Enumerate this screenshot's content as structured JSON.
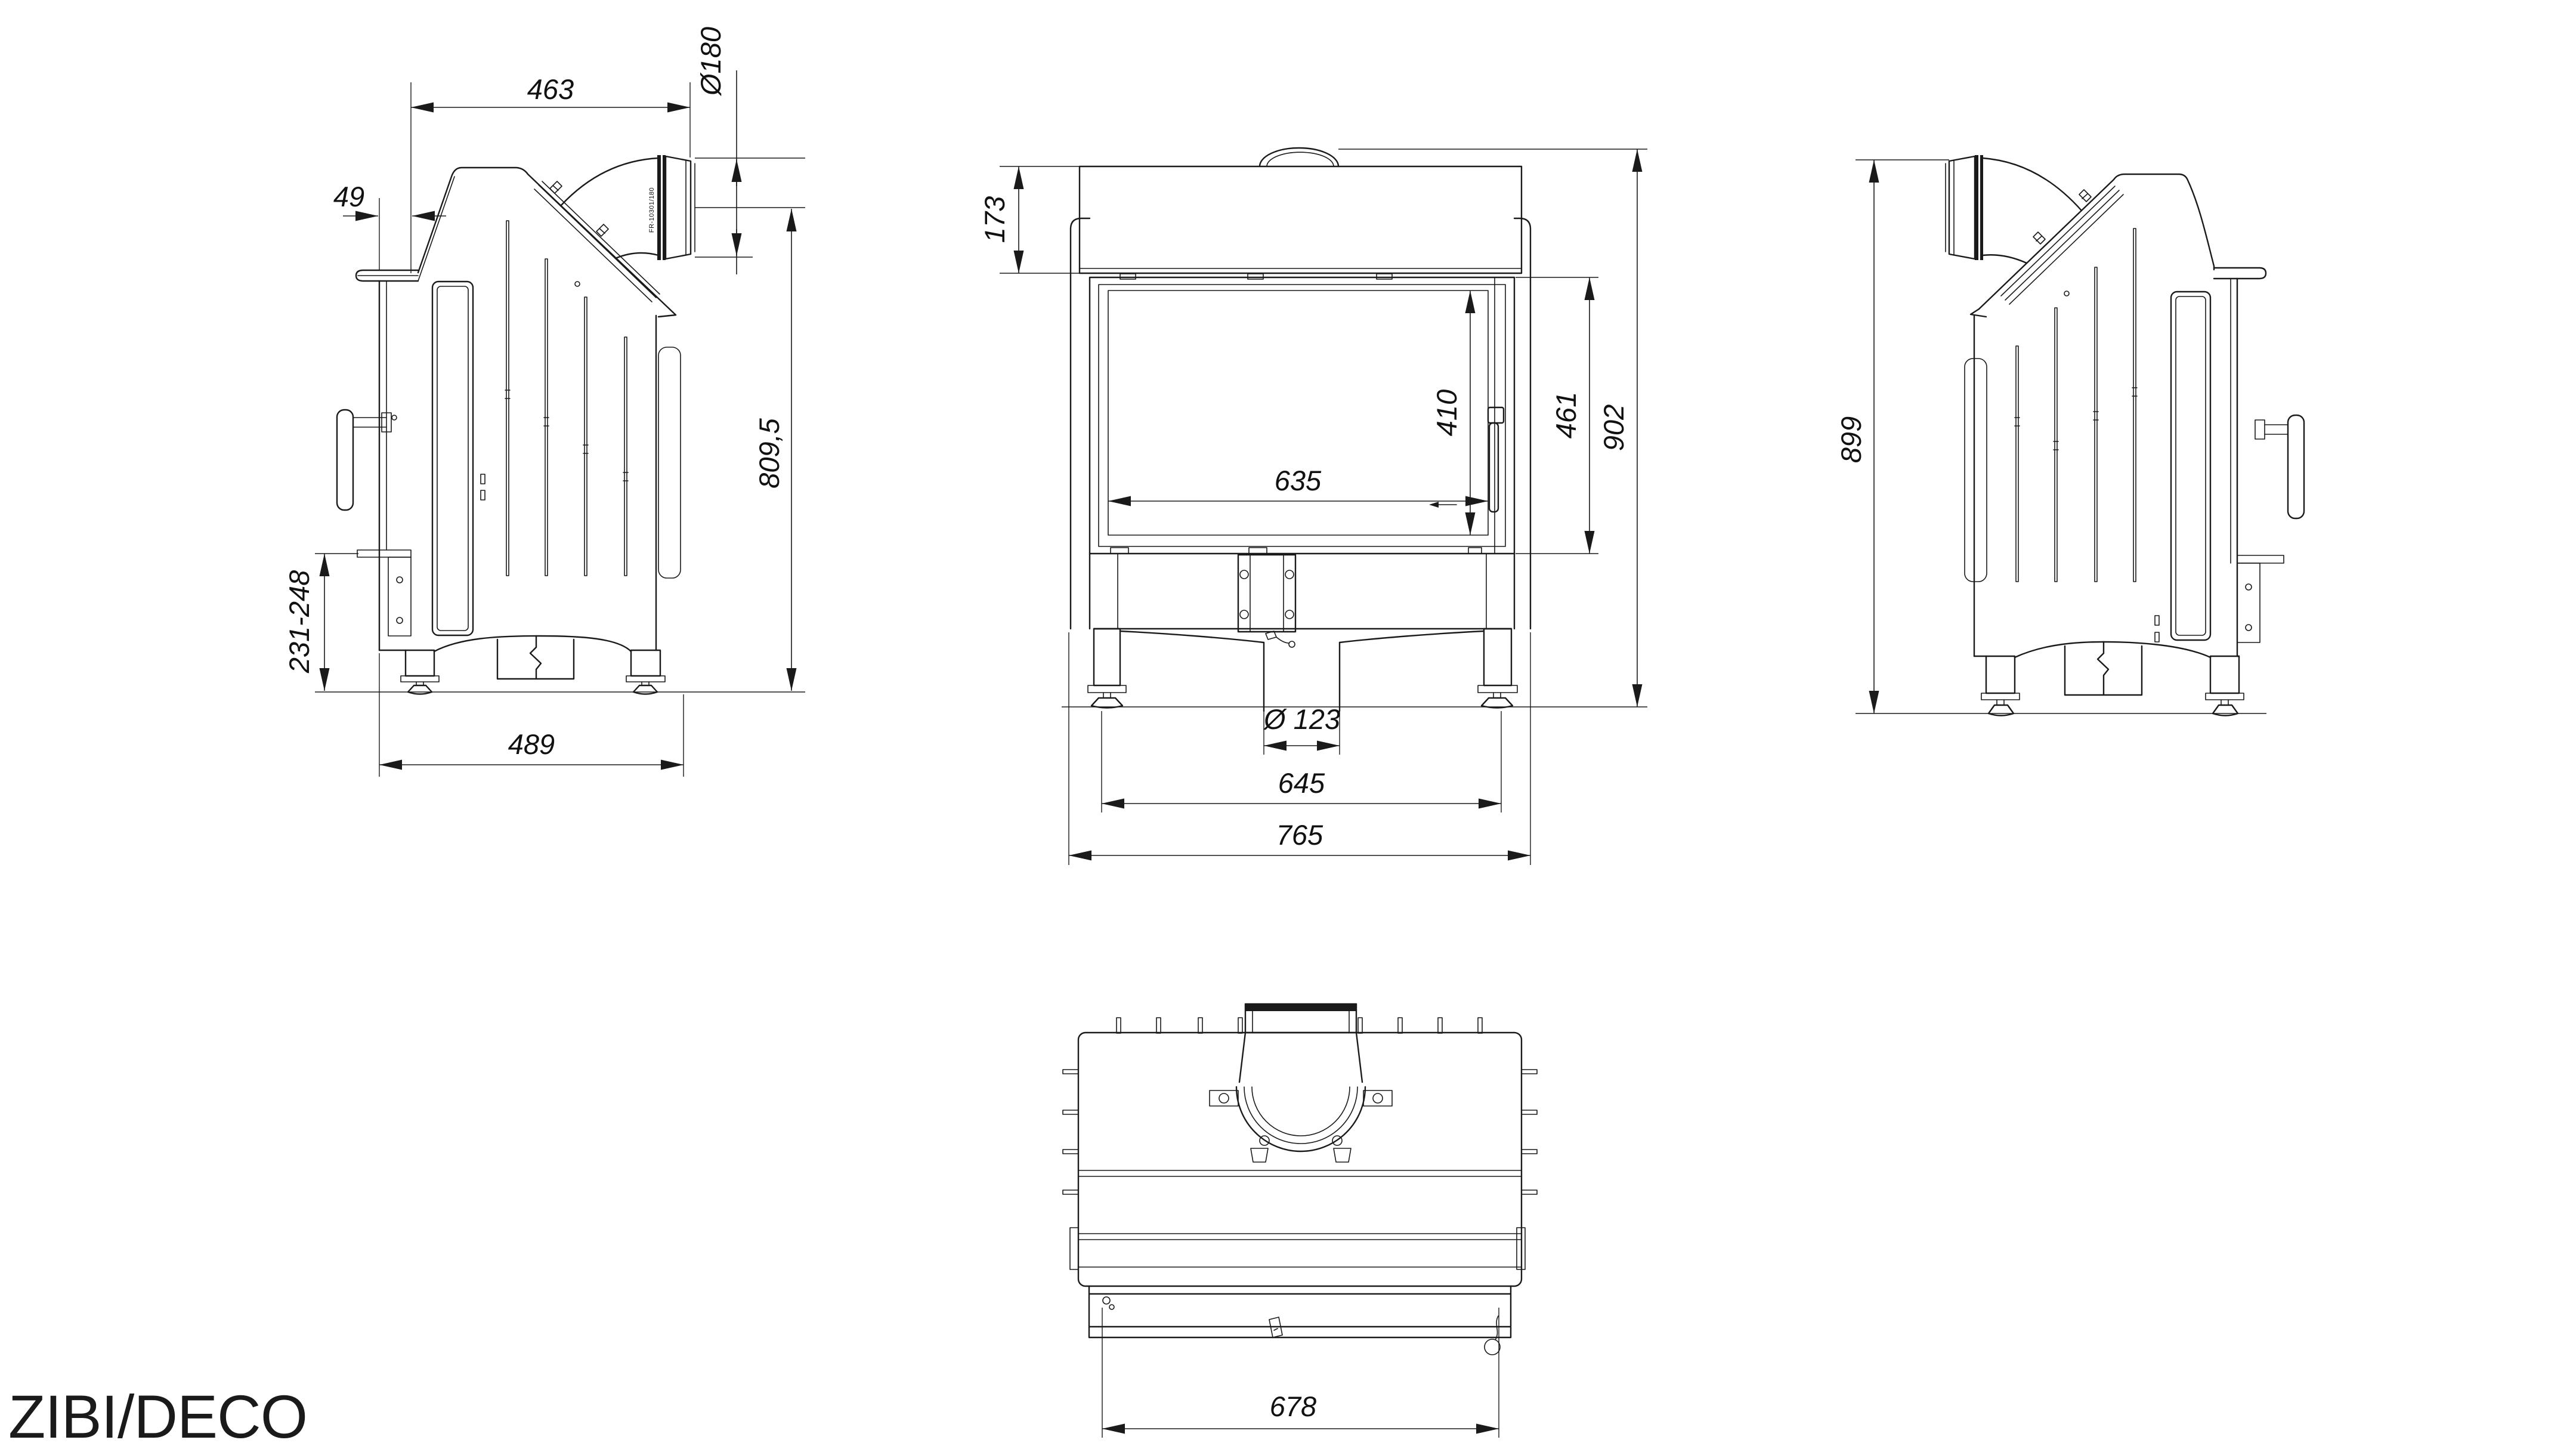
{
  "title": "ZIBI/DECO",
  "views": {
    "side_left": {
      "dims": {
        "top_width": "463",
        "flue_diameter": "Ø180",
        "front_offset": "49",
        "height_to_flue_axis": "809,5",
        "base_height": "231-248",
        "depth": "489"
      },
      "flue_marking": "FR-10301/180"
    },
    "front": {
      "dims": {
        "hood_height": "173",
        "glass_height": "410",
        "door_height": "461",
        "total_height": "902",
        "glass_width": "635",
        "air_inlet_diameter": "Ø 123",
        "feet_spacing": "645",
        "total_width": "765"
      }
    },
    "side_right": {
      "dims": {
        "total_height": "899"
      }
    },
    "top": {
      "dims": {
        "depth": "678"
      }
    }
  }
}
